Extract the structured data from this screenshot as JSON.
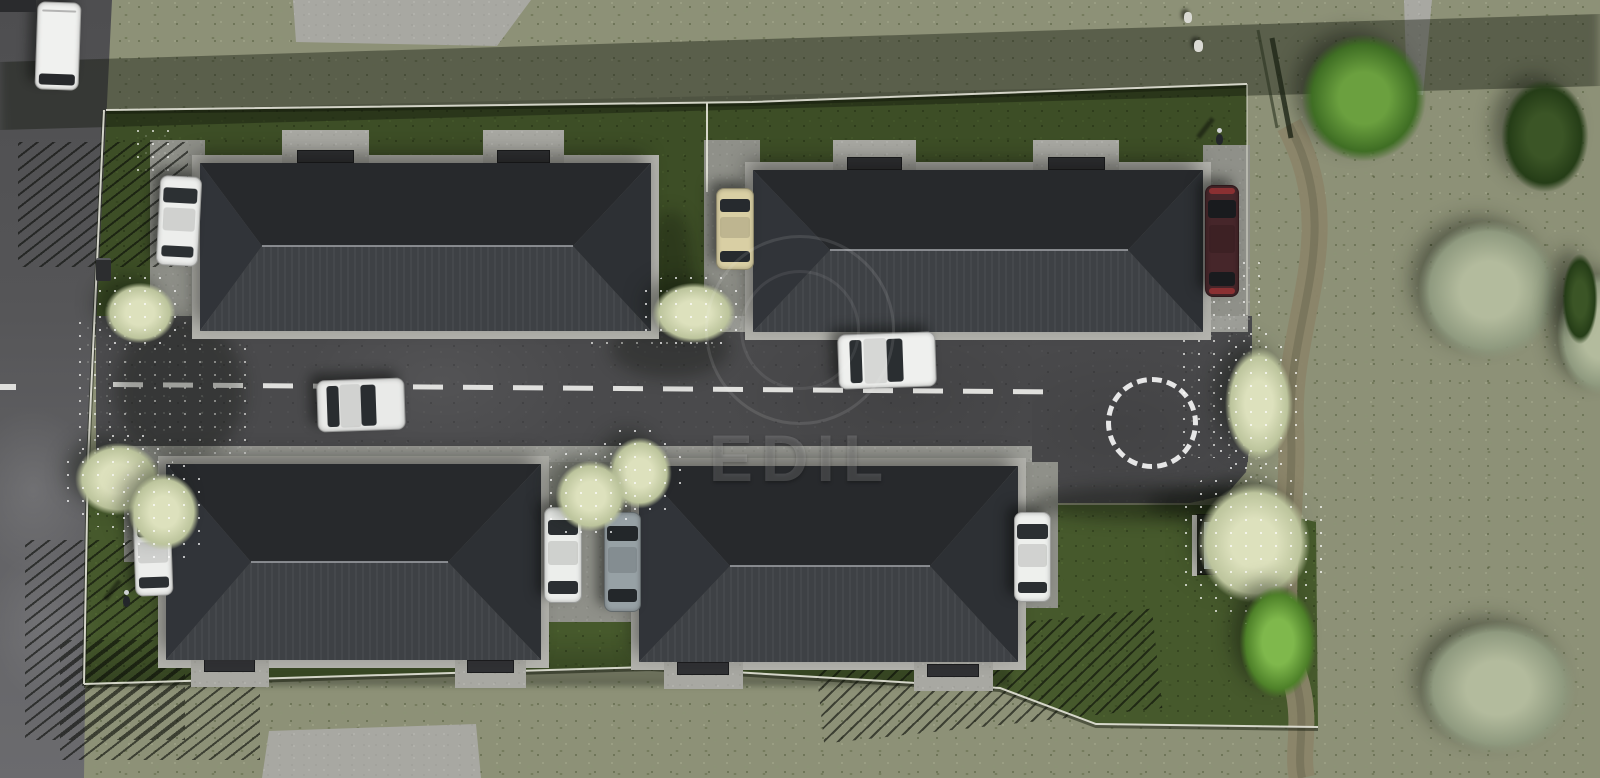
{
  "meta": {
    "scene_type": "aerial 3d architectural rendering",
    "subject": "residential development with four single-family houses along a private access road",
    "watermark": {
      "text": "EDIL"
    }
  },
  "scene": {
    "colors": {
      "olive_grass": "#8d9177",
      "lawn": "#46592c",
      "road": "#4a4a4c",
      "sidewalk": "#9d9e98",
      "driveway": "#8f9089",
      "pad": "#a8a8a2",
      "plinth": "#b4b4ae",
      "roof_north": "#27292c",
      "roof_south": "#3e4145",
      "roof_west": "#313439",
      "roof_east": "#2d3034",
      "ridge": "rgba(150,153,158,.85)",
      "road_marking": "#ededea",
      "dirt_path": "#8b8569",
      "mat": "#303134"
    },
    "houses": [
      {
        "id": "house-1",
        "x": 200,
        "y": 163,
        "w": 451,
        "h": 168,
        "ridge_x1": 262,
        "ridge_x2": 573,
        "ridge_y": 246,
        "pad_side": "top",
        "pads": [
          {
            "x": 282,
            "y": 130,
            "w": 87,
            "h": 35
          },
          {
            "x": 483,
            "y": 130,
            "w": 81,
            "h": 35
          }
        ]
      },
      {
        "id": "house-2",
        "x": 753,
        "y": 170,
        "w": 450,
        "h": 162,
        "ridge_x1": 830,
        "ridge_x2": 1128,
        "ridge_y": 250,
        "pad_side": "top",
        "pads": [
          {
            "x": 833,
            "y": 140,
            "w": 83,
            "h": 32
          },
          {
            "x": 1033,
            "y": 140,
            "w": 86,
            "h": 32
          }
        ]
      },
      {
        "id": "house-3",
        "x": 166,
        "y": 464,
        "w": 375,
        "h": 196,
        "ridge_x1": 251,
        "ridge_x2": 448,
        "ridge_y": 562,
        "pad_side": "bottom",
        "pads": [
          {
            "x": 191,
            "y": 657,
            "w": 78,
            "h": 30
          },
          {
            "x": 455,
            "y": 658,
            "w": 71,
            "h": 30
          }
        ]
      },
      {
        "id": "house-4",
        "x": 639,
        "y": 466,
        "w": 379,
        "h": 196,
        "ridge_x1": 730,
        "ridge_x2": 930,
        "ridge_y": 566,
        "pad_side": "bottom",
        "pads": [
          {
            "x": 664,
            "y": 660,
            "w": 79,
            "h": 29
          },
          {
            "x": 914,
            "y": 662,
            "w": 79,
            "h": 29
          }
        ]
      }
    ],
    "driveways": [
      [
        150,
        140,
        55,
        176
      ],
      [
        704,
        140,
        56,
        176
      ],
      [
        1203,
        145,
        47,
        171
      ],
      [
        124,
        462,
        54,
        100
      ],
      [
        536,
        462,
        112,
        160
      ],
      [
        1010,
        462,
        48,
        146
      ]
    ],
    "cars": [
      {
        "id": "van-white",
        "x": 36,
        "y": 2,
        "w": 44,
        "h": 88,
        "o": "v",
        "kind": "van",
        "body": "#f0f1ef",
        "glass": "#27292c",
        "angle": 2
      },
      {
        "id": "car-white-1",
        "x": 158,
        "y": 176,
        "w": 42,
        "h": 90,
        "o": "v",
        "kind": "car",
        "body": "#edeeec",
        "glass": "#2c3033",
        "angle": 3
      },
      {
        "id": "car-beige",
        "x": 716,
        "y": 188,
        "w": 38,
        "h": 82,
        "o": "v",
        "kind": "car",
        "body": "#d9cfa4",
        "glass": "#262a2e",
        "angle": 0
      },
      {
        "id": "car-dark-red",
        "x": 1205,
        "y": 185,
        "w": 34,
        "h": 112,
        "o": "v",
        "kind": "sport",
        "body": "#46262a",
        "glass": "#191b1e",
        "accent": "#8a3032",
        "angle": 0
      },
      {
        "id": "car-white-road-1",
        "x": 838,
        "y": 333,
        "w": 98,
        "h": 55,
        "o": "h",
        "kind": "car",
        "body": "#eff0ee",
        "glass": "#2a2e31",
        "angle": -2
      },
      {
        "id": "car-white-road-2",
        "x": 317,
        "y": 379,
        "w": 88,
        "h": 52,
        "o": "h",
        "kind": "car",
        "body": "#e9eae8",
        "glass": "#292d30",
        "angle": -2
      },
      {
        "id": "car-white-2",
        "x": 134,
        "y": 512,
        "w": 38,
        "h": 84,
        "o": "v",
        "kind": "car",
        "body": "#edeeec",
        "glass": "#2c3033",
        "angle": -2
      },
      {
        "id": "car-white-3",
        "x": 544,
        "y": 507,
        "w": 38,
        "h": 96,
        "o": "v",
        "kind": "car",
        "body": "#eceeeb",
        "glass": "#2b2f32",
        "angle": 0
      },
      {
        "id": "car-gray",
        "x": 604,
        "y": 512,
        "w": 37,
        "h": 100,
        "o": "v",
        "kind": "car",
        "body": "#97a1a5",
        "glass": "#23272a",
        "angle": 0
      },
      {
        "id": "car-white-4",
        "x": 1014,
        "y": 512,
        "w": 37,
        "h": 90,
        "o": "v",
        "kind": "car",
        "body": "#eef0ed",
        "glass": "#2b2f32",
        "angle": 0
      }
    ],
    "trees": [
      {
        "id": "blossom-tree-1",
        "type": "blossom",
        "x": 92,
        "y": 272,
        "w": 96,
        "h": 82
      },
      {
        "id": "blossom-tree-2",
        "type": "blossom",
        "x": 60,
        "y": 430,
        "w": 116,
        "h": 98
      },
      {
        "id": "blossom-tree-3",
        "type": "blossom",
        "x": 638,
        "y": 272,
        "w": 112,
        "h": 82
      },
      {
        "id": "blossom-tree-4",
        "type": "blossom",
        "x": 597,
        "y": 425,
        "w": 86,
        "h": 96
      },
      {
        "id": "blossom-tree-5",
        "type": "blossom",
        "x": 116,
        "y": 460,
        "w": 96,
        "h": 104
      },
      {
        "id": "blossom-tree-6",
        "type": "blossom",
        "x": 543,
        "y": 448,
        "w": 96,
        "h": 96
      },
      {
        "id": "blossom-tree-7",
        "type": "blossom",
        "x": 1213,
        "y": 328,
        "w": 92,
        "h": 152
      },
      {
        "id": "blossom-tree-8",
        "type": "blossom",
        "x": 1178,
        "y": 462,
        "w": 152,
        "h": 162
      },
      {
        "id": "green-tree",
        "type": "green",
        "x": 1280,
        "y": 12,
        "w": 168,
        "h": 172
      },
      {
        "id": "bright-bush",
        "type": "bright",
        "x": 1226,
        "y": 566,
        "w": 104,
        "h": 152
      },
      {
        "id": "sage-tree-1",
        "type": "sage",
        "x": 1393,
        "y": 196,
        "w": 192,
        "h": 188
      },
      {
        "id": "sage-tree-2",
        "type": "sage",
        "x": 1542,
        "y": 252,
        "w": 116,
        "h": 164
      },
      {
        "id": "sage-tree-3",
        "type": "sage",
        "x": 1393,
        "y": 598,
        "w": 210,
        "h": 180
      },
      {
        "id": "dark-bush-1",
        "type": "dark",
        "x": 1486,
        "y": 60,
        "w": 118,
        "h": 152
      },
      {
        "id": "dark-bush-2",
        "type": "dark",
        "x": 1556,
        "y": 238,
        "w": 48,
        "h": 122
      }
    ],
    "shed": {
      "x": 1196,
      "y": 514,
      "w": 62,
      "h": 61,
      "panels": [
        {
          "l": 6,
          "w": 14,
          "c": "#b7c3c6"
        },
        {
          "l": 24,
          "w": 12,
          "c": "#9fb0b4"
        },
        {
          "l": 44,
          "w": 13,
          "c": "#c9b24a"
        }
      ]
    },
    "people": [
      [
        1213,
        128
      ],
      [
        120,
        590
      ]
    ],
    "debris": [
      [
        1184,
        12,
        8,
        11
      ],
      [
        1194,
        40,
        9,
        12
      ]
    ],
    "bin": [
      96,
      258,
      15,
      23
    ],
    "dark_vehicle_edge": [
      0,
      0,
      36,
      12
    ],
    "streaks": [
      [
        18,
        142,
        170,
        125,
        0
      ],
      [
        25,
        540,
        160,
        200,
        0
      ],
      [
        60,
        640,
        200,
        120,
        0
      ],
      [
        845,
        252,
        180,
        60,
        6
      ],
      [
        1058,
        238,
        150,
        68,
        -18
      ],
      [
        818,
        626,
        340,
        100,
        -6
      ]
    ],
    "petals": [
      [
        588,
        286,
        130,
        66
      ],
      [
        76,
        318,
        170,
        140
      ],
      [
        592,
        458,
        100,
        64
      ],
      [
        1180,
        258,
        84,
        200
      ],
      [
        134,
        126,
        44,
        46
      ]
    ],
    "road_markings": {
      "centerline": {
        "x": 113,
        "y": 382,
        "length": 937,
        "dash": 30,
        "gap": 20,
        "tilt_deg": 0.45
      },
      "turning_circle": {
        "x": 1106,
        "y": 377,
        "d": 92
      },
      "left_road_dash": {
        "x": 0,
        "y": 384,
        "w": 16,
        "h": 6
      }
    }
  }
}
